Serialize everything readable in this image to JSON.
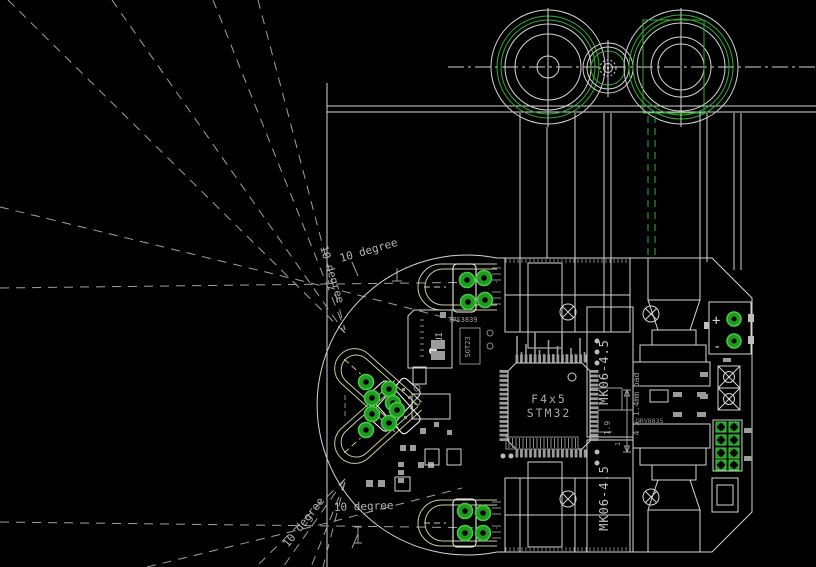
{
  "canvas": {
    "width": 816,
    "height": 567,
    "background": "#000000"
  },
  "colors": {
    "line": "#d4d4d4",
    "dim_line": "#9f9f9f",
    "annotation_text": "#b3b3b3",
    "green": "#2fae2f",
    "pad_green": "#209920",
    "pad_ring": "#44cc44",
    "sensor_outline": "#cbcb94",
    "component_gray": "#9b9b9b",
    "chip_text": "#a8a8a8"
  },
  "annotations": {
    "angle_front_top": "10 degree",
    "angle_diag_top": "10 degree",
    "angle_front_bottom": "10 degree",
    "angle_diag_bottom": "10 degree",
    "dim_pad": "4 x 1.4mm pad",
    "dim_gap": "1.9",
    "dim_one": "1"
  },
  "components": {
    "mcu_line1": "F4x5",
    "mcu_line2": "STM32",
    "motor_top": "MK06-4.5",
    "motor_bottom": "MK06-4.5",
    "supervisor": "TPS3839",
    "supervisor_pkg": "SOT23",
    "buzzer": "PUI",
    "motor_driver": "DRV8835",
    "battery_plus": "+",
    "battery_minus": "-"
  }
}
